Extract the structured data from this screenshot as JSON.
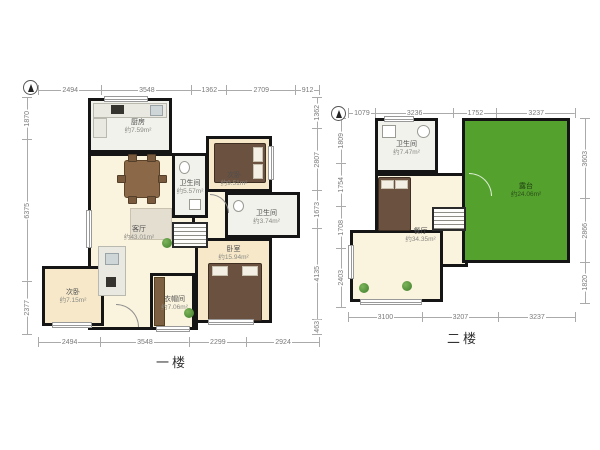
{
  "floor1": {
    "label": "一楼",
    "rooms": {
      "kitchen": {
        "name": "厨房",
        "area": "约7.59m²"
      },
      "bath1": {
        "name": "卫生间",
        "area": "约5.57m²"
      },
      "bedroom_tr": {
        "name": "次卧",
        "area": "约9.51m²"
      },
      "bath2": {
        "name": "卫生间",
        "area": "约3.74m²"
      },
      "living": {
        "name": "客厅",
        "area": "约43.01m²"
      },
      "master": {
        "name": "卧室",
        "area": "约15.94m²"
      },
      "cloak": {
        "name": "衣帽间",
        "area": "约7.06m²"
      },
      "bedroom_bl": {
        "name": "次卧",
        "area": "约7.15m²"
      }
    },
    "dims": {
      "top": [
        "2494",
        "3548",
        "1362",
        "2709",
        "912"
      ],
      "bottom": [
        "2494",
        "3548",
        "2299",
        "2924"
      ],
      "left": [
        "1870",
        "6375",
        "2377"
      ],
      "right": [
        "1362",
        "2807",
        "1673",
        "4135",
        "463"
      ]
    }
  },
  "floor2": {
    "label": "二楼",
    "rooms": {
      "bath": {
        "name": "卫生间",
        "area": "约7.47m²"
      },
      "dining": {
        "name": "餐厅",
        "area": "约34.35m²"
      },
      "terrace": {
        "name": "露台",
        "area": "约24.06m²"
      }
    },
    "dims": {
      "top": [
        "1079",
        "3236",
        "1752",
        "3237"
      ],
      "bottom": [
        "3100",
        "3207",
        "3237"
      ],
      "left": [
        "1809",
        "1754",
        "1708",
        "2403"
      ],
      "right": [
        "3603",
        "2866",
        "1820"
      ]
    }
  },
  "icons": {
    "compass": "north-arrow-compass",
    "stairs": "staircase",
    "plant": "potted-plant"
  },
  "colors": {
    "wall": "#151515",
    "floor_warm": "#faf3dd",
    "floor_tile": "#f2f2ec",
    "floor_bedroom": "#f6e8c8",
    "terrace_green": "#54a12e"
  }
}
